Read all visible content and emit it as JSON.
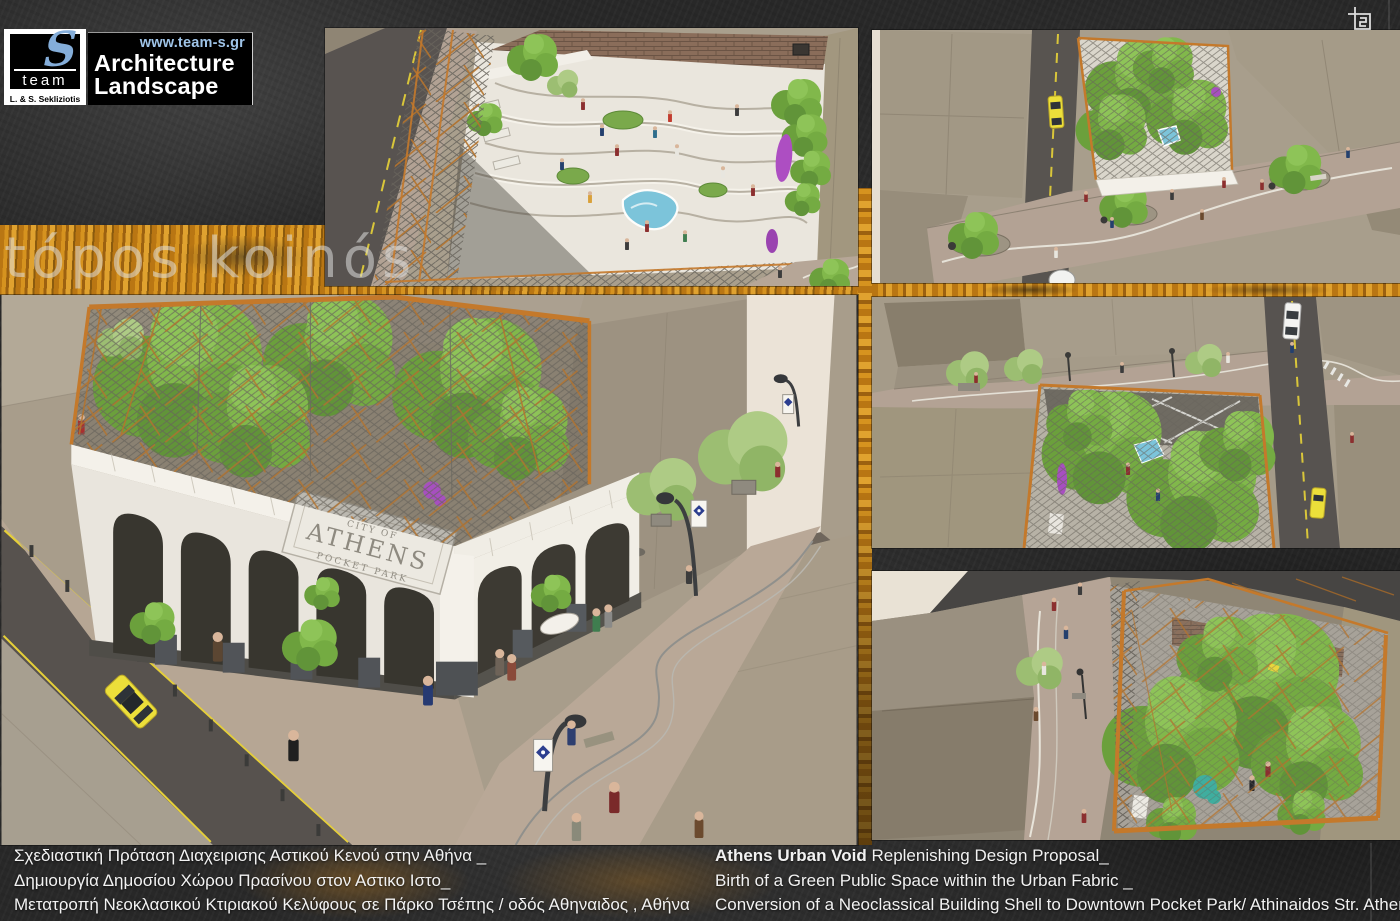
{
  "logo": {
    "brand": "team",
    "initial": "S",
    "subtitle": "L. & S. Sekliziotis",
    "website": "www.team-s.gr",
    "line1": "Architecture",
    "line2": "Landscape"
  },
  "watermark": "tópos koinós",
  "building_sign": {
    "line1": "CITY OF",
    "line2": "ATHENS",
    "line3": "POCKET PARK"
  },
  "captions": {
    "greek": [
      "Σχεδιαστική Πρόταση Διαχειρισης Αστικού Κενού στην Αθήνα _",
      "Δημιουργία Δημοσίου Χώρου Πρασίνου στον Αστικο Ιστο_",
      "Μετατροπή Νεοκλασικού Κτιριακού Κελύφους σε Πάρκο Τσέπης / οδός Αθηναιδος , Αθήνα"
    ],
    "english": {
      "lead_bold": "Athens Urban Void",
      "line1_rest": " Replenishing Design Proposal_",
      "line2": "Birth of a Green Public Space within the Urban Fabric _",
      "line3": "Conversion of a Neoclassical Building Shell to Downtown Pocket Park/ Athinaidos Str. Athens"
    }
  },
  "icons": {
    "top_right": "crop-frame-icon",
    "logo_mark": "team-s-logo"
  },
  "colors": {
    "background": "#282828",
    "accent_orange": "#c9801e",
    "logo_blue": "#84add9",
    "website_blue": "#9fc4e8",
    "watermark_gray": "#dededc",
    "caption_white": "#f2f2f2",
    "render_tree_green": "#7fb24a",
    "render_pool_teal": "#7cc4da",
    "render_taxi_yellow": "#ecdf3a"
  }
}
